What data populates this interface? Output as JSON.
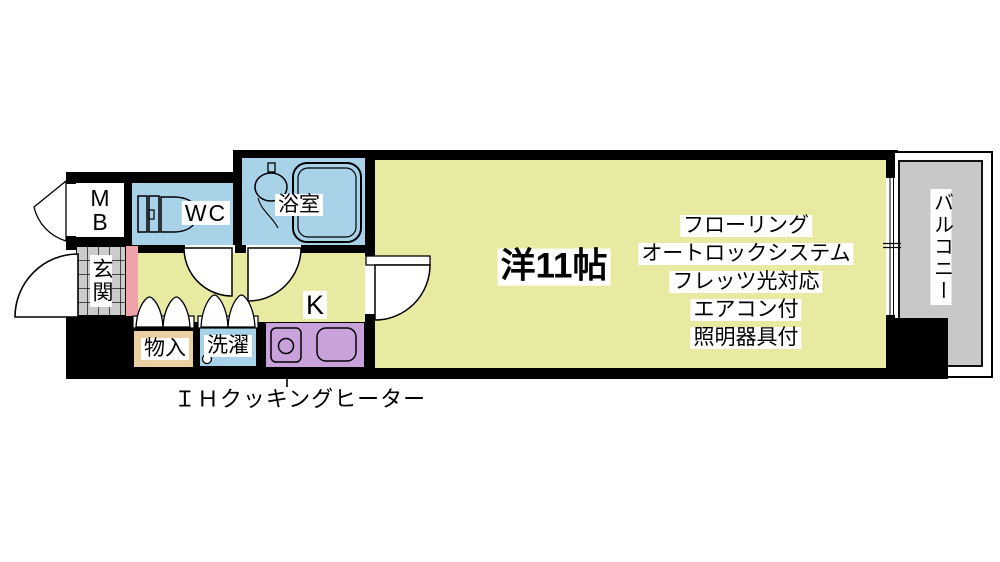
{
  "labels": {
    "mb": "M\nB",
    "genkan": "玄関",
    "wc": "WC",
    "bath": "浴室",
    "storage": "物入",
    "laundry": "洗濯",
    "kitchen": "K",
    "main_room": "洋11帖",
    "balcony": "バルコニー",
    "ih_note": "ＩＨクッキングヒーター"
  },
  "features": [
    "フローリング",
    "オートロックシステム",
    "フレッツ光対応",
    "エアコン付",
    "照明器具付"
  ],
  "colors": {
    "floor": "#e9eaa2",
    "water": "#a7d2e8",
    "counter": "#c9a2db",
    "storage_fill": "#ebcfa2",
    "step": "#f0a2ab",
    "balcony_floor": "#c8c8c8",
    "tile": "#cbcbcb",
    "wall": "#000000",
    "background": "#ffffff"
  }
}
